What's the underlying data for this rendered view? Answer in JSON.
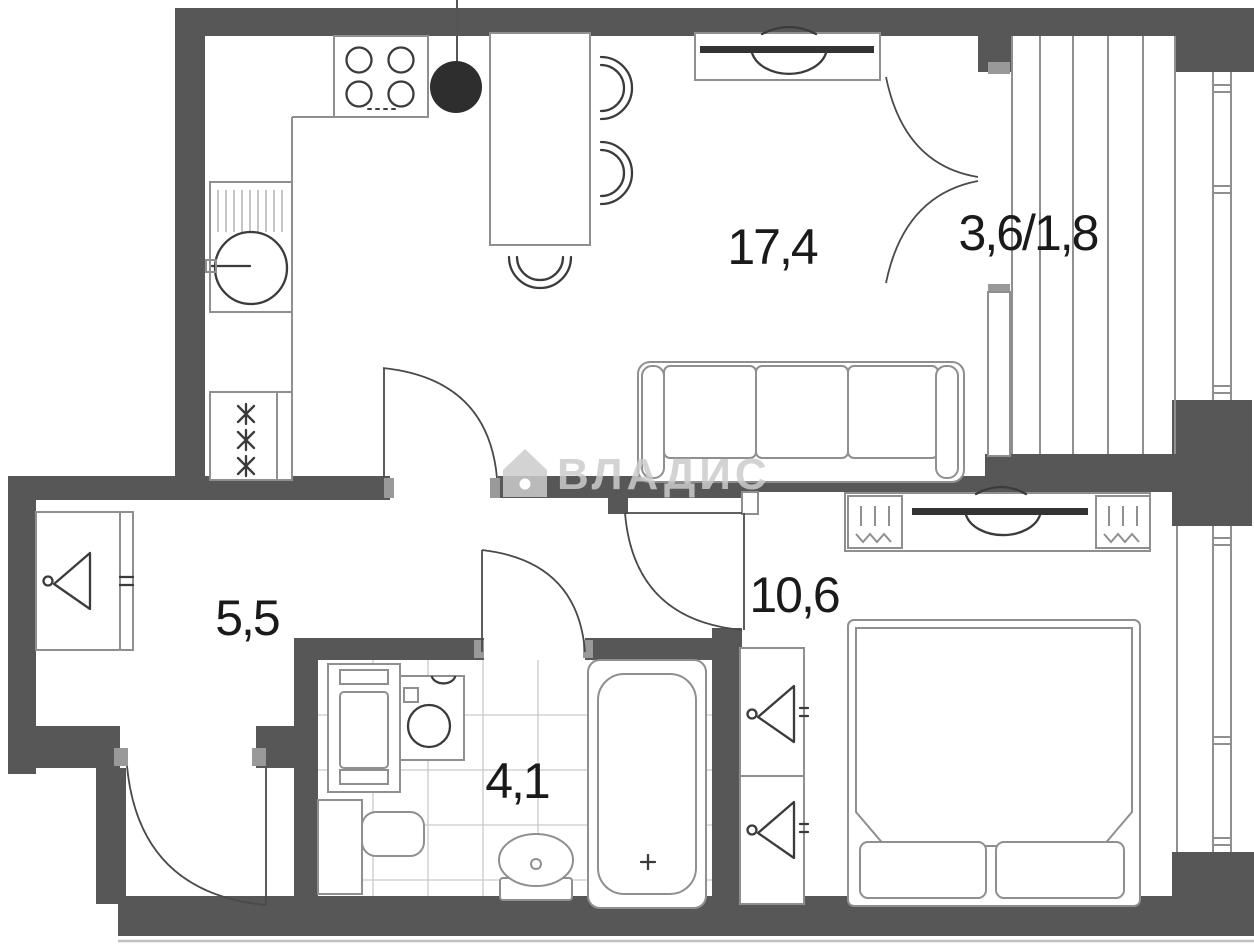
{
  "watermark": {
    "text": "ВЛАДИС",
    "icon": "house-icon"
  },
  "rooms": {
    "living_kitchen": {
      "area_label": "17,4"
    },
    "balcony": {
      "area_label": "3,6/1,8"
    },
    "hallway": {
      "area_label": "5,5"
    },
    "bedroom": {
      "area_label": "10,6"
    },
    "bathroom": {
      "area_label": "4,1"
    }
  },
  "icons": {
    "fridge": "snowflake-icon-x3",
    "wardrobes": "hanger-icon",
    "bath_drain": "cross-icon",
    "watermark_logo": "house-icon"
  },
  "colors": {
    "wall": "#575757",
    "furniture_line": "#8f8f8f",
    "detail_line": "#3b3b3b",
    "tile_line": "#c9c9c9",
    "label_text": "#1a1a1a",
    "watermark": "#cbcbcb",
    "vent_fill": "#2e2e2e",
    "background": "#ffffff"
  }
}
